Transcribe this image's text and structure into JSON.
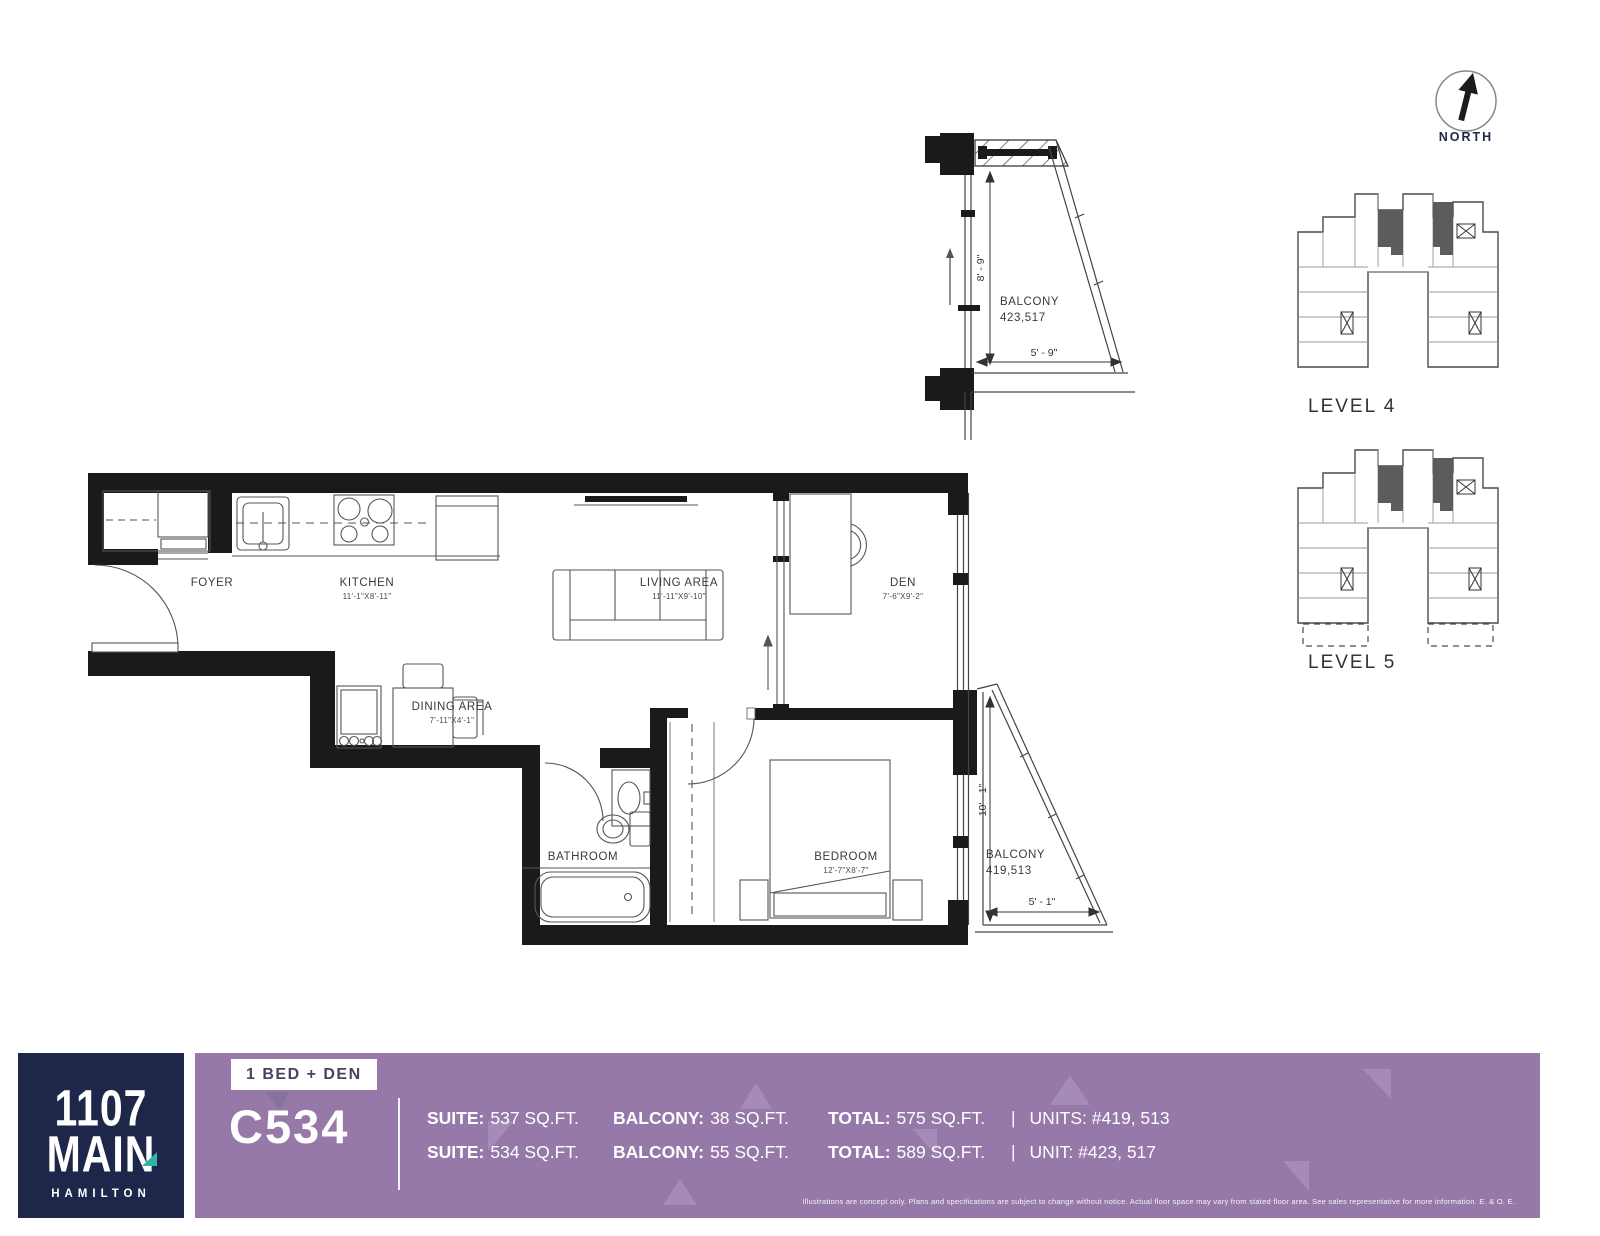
{
  "north_label": "NORTH",
  "balcony_detail": {
    "name": "BALCONY",
    "units": "423,517",
    "height_dim": "8' - 9\"",
    "width_dim": "5' - 9\""
  },
  "rooms": {
    "foyer": {
      "name": "FOYER"
    },
    "kitchen": {
      "name": "KITCHEN",
      "dims": "11'-1\"X8'-11\""
    },
    "living": {
      "name": "LIVING AREA",
      "dims": "11'-11\"X9'-10\""
    },
    "den": {
      "name": "DEN",
      "dims": "7'-6\"X9'-2\""
    },
    "dining": {
      "name": "DINING AREA",
      "dims": "7'-11\"X4'-1\""
    },
    "bathroom": {
      "name": "BATHROOM"
    },
    "bedroom": {
      "name": "BEDROOM",
      "dims": "12'-7\"X8'-7\""
    }
  },
  "balcony_main": {
    "name": "BALCONY",
    "units": "419,513",
    "height_dim": "10' - 1\"",
    "width_dim": "5' - 1\""
  },
  "levels": [
    {
      "label": "LEVEL 4"
    },
    {
      "label": "LEVEL 5"
    }
  ],
  "footer": {
    "logo": {
      "line1": "1107",
      "line2": "MAIN",
      "city": "HAMILTON"
    },
    "plan_type": "1 BED + DEN",
    "unit_code": "C534",
    "pipe": "|",
    "rows": [
      {
        "suite_label": "SUITE:",
        "suite_value": "537 SQ.FT.",
        "balcony_label": "BALCONY:",
        "balcony_value": "38 SQ.FT.",
        "total_label": "TOTAL:",
        "total_value": "575 SQ.FT.",
        "units_value": "UNITS: #419, 513"
      },
      {
        "suite_label": "SUITE:",
        "suite_value": "534 SQ.FT.",
        "balcony_label": "BALCONY:",
        "balcony_value": "55 SQ.FT.",
        "total_label": "TOTAL:",
        "total_value": "589 SQ.FT.",
        "units_value": "UNIT: #423, 517"
      }
    ],
    "disclaimer": "Illustrations are concept only. Plans and specifications are subject to change without notice. Actual floor space may vary from stated floor area. See sales representative for more information. E. & O. E."
  },
  "colors": {
    "purple": "#9679a8",
    "navy": "#1e2749",
    "teal": "#2cb4ad"
  }
}
